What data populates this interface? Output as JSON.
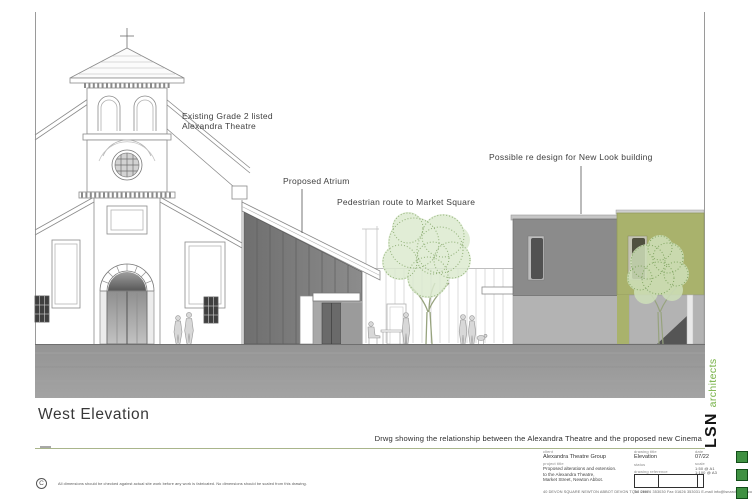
{
  "drawing": {
    "title": "West Elevation",
    "caption": "Drwg showing the relationship between the Alexandra Theatre and the proposed new Cinema",
    "annotations": {
      "existing_line1": "Existing Grade 2 listed",
      "existing_line2": "Alexandra Theatre",
      "atrium": "Proposed Atrium",
      "pedestrian": "Pedestrian route to Market Square",
      "newlook": "Possible re design for New Look building"
    },
    "disclaimer": "All dimensions should be checked against actual site work before any work is fabricated.      No dimensions should be scaled from this drawing.",
    "copyright_mark": "C"
  },
  "title_block": {
    "client_label": "client",
    "client": "Alexandra Theatre Group",
    "project_label": "project title",
    "project_lines": [
      "Proposed alterations and extension.",
      "to the Alexandra Theatre,",
      "Market Street, Newton Abbot."
    ],
    "drawing_title_label": "drawing title",
    "drawing_title": "Elevation",
    "status_label": "status",
    "reference_label": "drawing reference",
    "date_label": "date",
    "date": "07/22",
    "scale_label": "scale",
    "scale_line1": "1:50 @ A1",
    "scale_line2": "1:100 @ A3",
    "address": "40 DEVON SQUARE   NEWTON ABBOT   DEVON   TQ12 2HH",
    "contact": "Tel 01626 353030   Fax 01626 353031   E-mail info@lsnarchitects.co.uk"
  },
  "branding": {
    "firm": "LSN",
    "suffix": "architects"
  },
  "colors": {
    "accent_green": "#74b043",
    "square_green": "#3f9142",
    "olive_building": "#a9b26c",
    "dark_grey_building": "#8b8b8b",
    "light_grey_building": "#b3b3b3",
    "atrium_glass": "#767676",
    "ground_grey": "#9b9b9b",
    "rule_green": "#a9b58b"
  }
}
